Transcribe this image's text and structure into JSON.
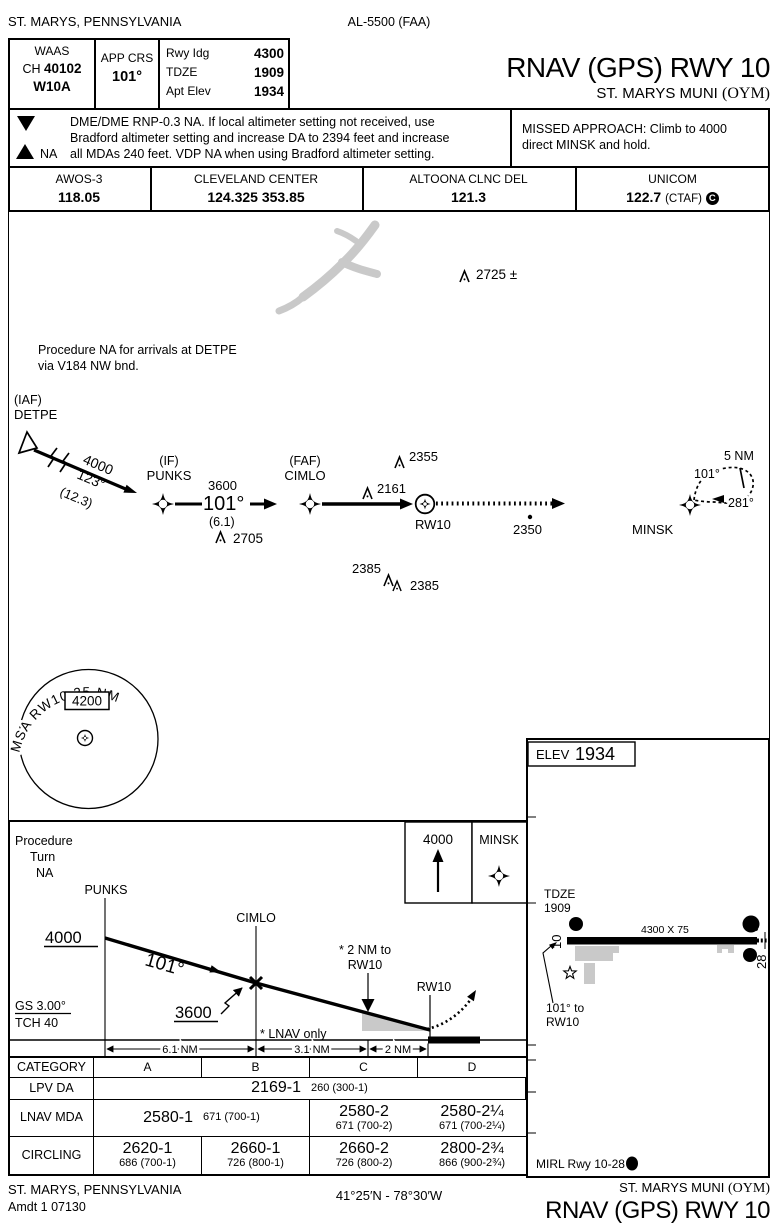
{
  "header": {
    "city": "ST. MARYS, PENNSYLVANIA",
    "procedure_ref": "AL-5500 (FAA)",
    "title": "RNAV (GPS) RWY 10",
    "airport": "ST. MARYS MUNI",
    "airport_id": "(OYM)"
  },
  "briefing": {
    "waas_label": "WAAS",
    "channel_prefix": "CH",
    "channel": "40102",
    "waas_id": "W10A",
    "app_crs_label": "APP CRS",
    "app_crs": "101°",
    "rwy_ldg_label": "Rwy Idg",
    "rwy_ldg": "4300",
    "tdze_label": "TDZE",
    "tdze": "1909",
    "apt_elev_label": "Apt Elev",
    "apt_elev": "1934"
  },
  "notes": {
    "takeoff_symbol": "T",
    "alternate_symbol": "A",
    "alternate_na": "NA",
    "line1": "DME/DME RNP-0.3 NA.  If local altimeter setting not received, use",
    "line2": "Bradford altimeter setting and increase DA to 2394 feet and increase",
    "line3": "all MDAs 240 feet.  VDP NA when using Bradford altimeter setting.",
    "missed_line1": "MISSED APPROACH:  Climb to 4000",
    "missed_line2": "direct MINSK and hold."
  },
  "frequencies": {
    "awos_label": "AWOS-3",
    "awos": "118.05",
    "center_label": "CLEVELAND CENTER",
    "center": "124.325  353.85",
    "clnc_label": "ALTOONA CLNC DEL",
    "clnc": "121.3",
    "unicom_label": "UNICOM",
    "unicom": "122.7",
    "ctaf": "(CTAF)",
    "ctaf_symbol": "C"
  },
  "plan": {
    "arrival_note1": "Procedure NA for arrivals at DETPE",
    "arrival_note2": "via V184 NW bnd.",
    "iaf_label": "(IAF)",
    "iaf": "DETPE",
    "leg1_alt": "4000",
    "leg1_crs": "123°",
    "leg1_dist": "(12.3)",
    "if_label": "(IF)",
    "if": "PUNKS",
    "leg2_alt": "3600",
    "leg2_crs": "101°",
    "leg2_dist": "(6.1)",
    "faf_label": "(FAF)",
    "faf": "CIMLO",
    "rwy_fix": "RW10",
    "minsk": "MINSK",
    "hold_leg": "5 NM",
    "hold_out": "101°",
    "hold_in": "281°",
    "obst_2725": "2725 ±",
    "obst_2355": "2355",
    "obst_2161": "2161",
    "obst_2705": "2705",
    "obst_2350": "2350",
    "obst_2385a": "2385",
    "obst_2385b": "2385",
    "msa_arc": "MSA RW10 25 NM",
    "msa_alt": "4200"
  },
  "profile": {
    "pt1": "Procedure",
    "pt2": "Turn",
    "pt3": "NA",
    "fix1": "PUNKS",
    "fix2": "CIMLO",
    "alt1": "4000",
    "crs": "101°",
    "alt2": "3600",
    "vdp1": "* 2 NM to",
    "vdp2": "RW10",
    "rwy": "RW10",
    "lnav_note": "* LNAV only",
    "gs": "GS 3.00°",
    "tch": "TCH 40",
    "d1": "6.1 NM",
    "d2": "3.1 NM",
    "d3": "2 NM",
    "ma_alt": "4000",
    "ma_fix": "MINSK"
  },
  "minima": {
    "category_label": "CATEGORY",
    "cat_a": "A",
    "cat_b": "B",
    "cat_c": "C",
    "cat_d": "D",
    "lpv_label": "LPV DA",
    "lpv_value": "2169-1",
    "lpv_sub": "260 (300-1)",
    "lnav_label": "LNAV MDA",
    "lnav_ab_value": "2580-1",
    "lnav_ab_sub": "671 (700-1)",
    "lnav_c_value": "2580-2",
    "lnav_c_sub": "671 (700-2)",
    "lnav_d_value": "2580-2¼",
    "lnav_d_sub": "671 (700-2¼)",
    "circ_label": "CIRCLING",
    "circ_a_value": "2620-1",
    "circ_a_sub": "686 (700-1)",
    "circ_b_value": "2660-1",
    "circ_b_sub": "726 (800-1)",
    "circ_c_value": "2660-2",
    "circ_c_sub": "726 (800-2)",
    "circ_d_value": "2800-2¾",
    "circ_d_sub": "866 (900-2¾)"
  },
  "sketch": {
    "elev_label": "ELEV",
    "elev": "1934",
    "tdze_label": "TDZE",
    "tdze": "1909",
    "rwy_dims": "4300 X 75",
    "rwy_end_10": "10",
    "rwy_end_28": "28",
    "light_symbol": "A",
    "light_symbol_sub": "4",
    "papi_symbol": "P",
    "crs1": "101° to",
    "crs2": "RW10",
    "lighting_note": "MIRL Rwy 10-28",
    "lighting_symbol": "L"
  },
  "footer": {
    "city": "ST. MARYS, PENNSYLVANIA",
    "amendment": "Amdt 1  07130",
    "coords": "41°25′N - 78°30′W",
    "airport": "ST. MARYS MUNI",
    "airport_id": "(OYM)",
    "title": "RNAV (GPS) RWY 10"
  }
}
